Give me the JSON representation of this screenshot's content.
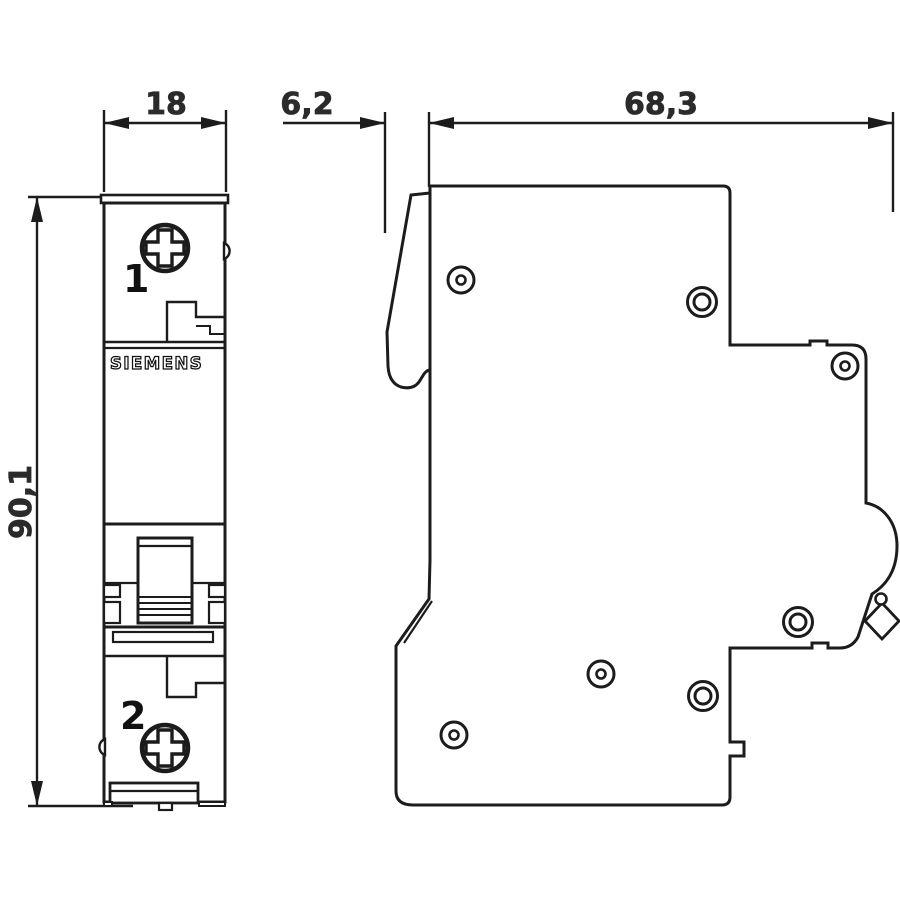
{
  "drawing": {
    "title": "circuit-breaker-dimension-drawing",
    "brand": "SIEMENS",
    "dimensions": {
      "width": "18",
      "toggle_depth": "6,2",
      "depth": "68,3",
      "height": "90,1"
    },
    "terminals": {
      "top": "1",
      "bottom": "2"
    },
    "colors": {
      "line": "#1c1c1c",
      "dim_text": "#2b2b2b",
      "background": "#ffffff"
    }
  }
}
